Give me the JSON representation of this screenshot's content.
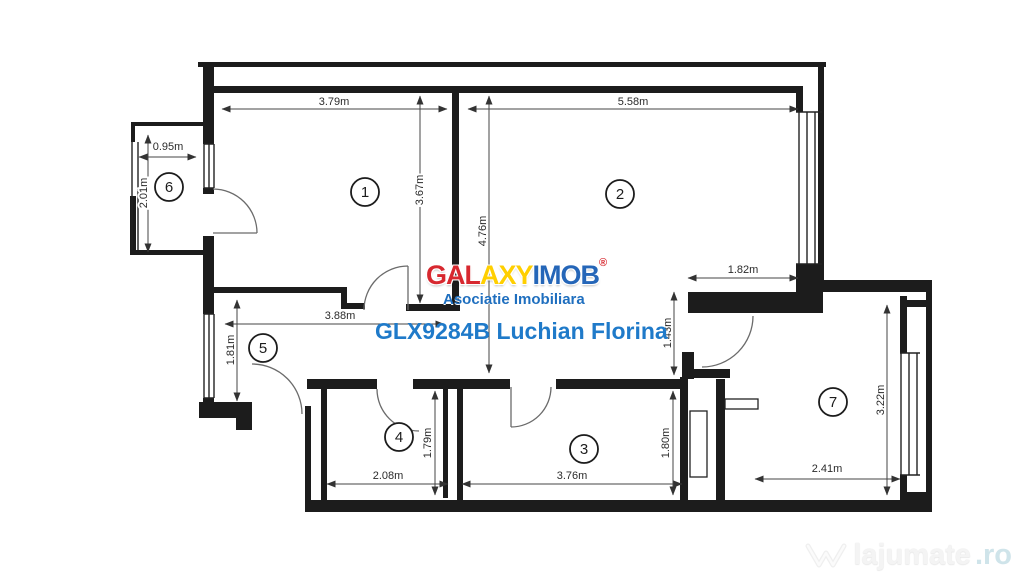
{
  "floor_plan": {
    "rooms": {
      "r1": "1",
      "r2": "2",
      "r3": "3",
      "r4": "4",
      "r5": "5",
      "r6": "6",
      "r7": "7"
    },
    "dimensions": {
      "room1_width": "3.79m",
      "room2_width": "5.58m",
      "balcony_width": "0.95m",
      "balcony_depth": "2.01m",
      "room1_depth": "3.67m",
      "room2_depth": "4.76m",
      "entry_width": "1.82m",
      "corridor_depth": "1.43m",
      "hallway_width": "3.88m",
      "hallway_depth": "1.81m",
      "room7_depth": "3.22m",
      "room4_depth": "1.79m",
      "room4_width": "2.08m",
      "room3_width": "3.76m",
      "room3_depth": "1.80m",
      "room7_width": "2.41m"
    }
  },
  "branding": {
    "logo": {
      "segments": [
        {
          "text": "GAL",
          "color": "#d7282f"
        },
        {
          "text": "AXY",
          "color": "#ffcf00"
        },
        {
          "text": "IMOB",
          "color": "#2566b8"
        }
      ],
      "registered": "®",
      "subtitle": "Asociatie Imobiliara"
    },
    "listing_line": "GLX9284B Luchian Florina"
  },
  "watermark": {
    "brand": "lajumate",
    "tld": ".ro"
  },
  "colors": {
    "logo_red": "#d7282f",
    "logo_yellow": "#ffcf00",
    "logo_blue": "#2566b8",
    "subtitle_blue": "#1f6fbf",
    "listing_blue": "#1f7ac9",
    "watermark_ro": "#cfe4ea",
    "plan_line": "#1c1c1c"
  }
}
